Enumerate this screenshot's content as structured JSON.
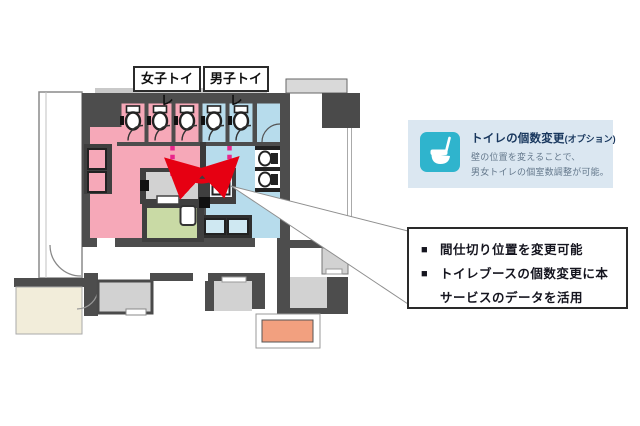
{
  "labels": {
    "women": "女子トイレ",
    "men": "男子トイレ"
  },
  "callout": {
    "title": "トイレの個数変更",
    "title_suffix": "(オプション)",
    "body_line1": "壁の位置を変えることで、",
    "body_line2": "男女トイレの個室数調整が可能。",
    "bg_color": "#dbe7f1",
    "icon_color": "#2fb4cd",
    "title_color": "#17365d"
  },
  "notes": {
    "items": [
      {
        "marker": "■",
        "text": "間仕切り位置を変更可能"
      },
      {
        "marker": "■",
        "text": "トイレブースの個数変更に本"
      },
      {
        "marker": "",
        "text": "サービスのデータを活用"
      }
    ]
  },
  "plan": {
    "colors": {
      "wall": "#4d4d4d",
      "women_area": "#f6a8b8",
      "men_area": "#b7dcec",
      "ps_room_gray": "#d2d2d2",
      "utility_room_green": "#c9daa5",
      "lobby_room_cream": "#f2edda",
      "escalator_salmon": "#f2a07f",
      "movable_partition_dash": "#e8268c",
      "swap_arrow_red": "#e60012"
    },
    "fixtures": {
      "women_toilet_stalls": 3,
      "men_toilet_stalls": 2,
      "urinals": 2,
      "women_sinks": 2,
      "men_sinks": 2
    }
  }
}
